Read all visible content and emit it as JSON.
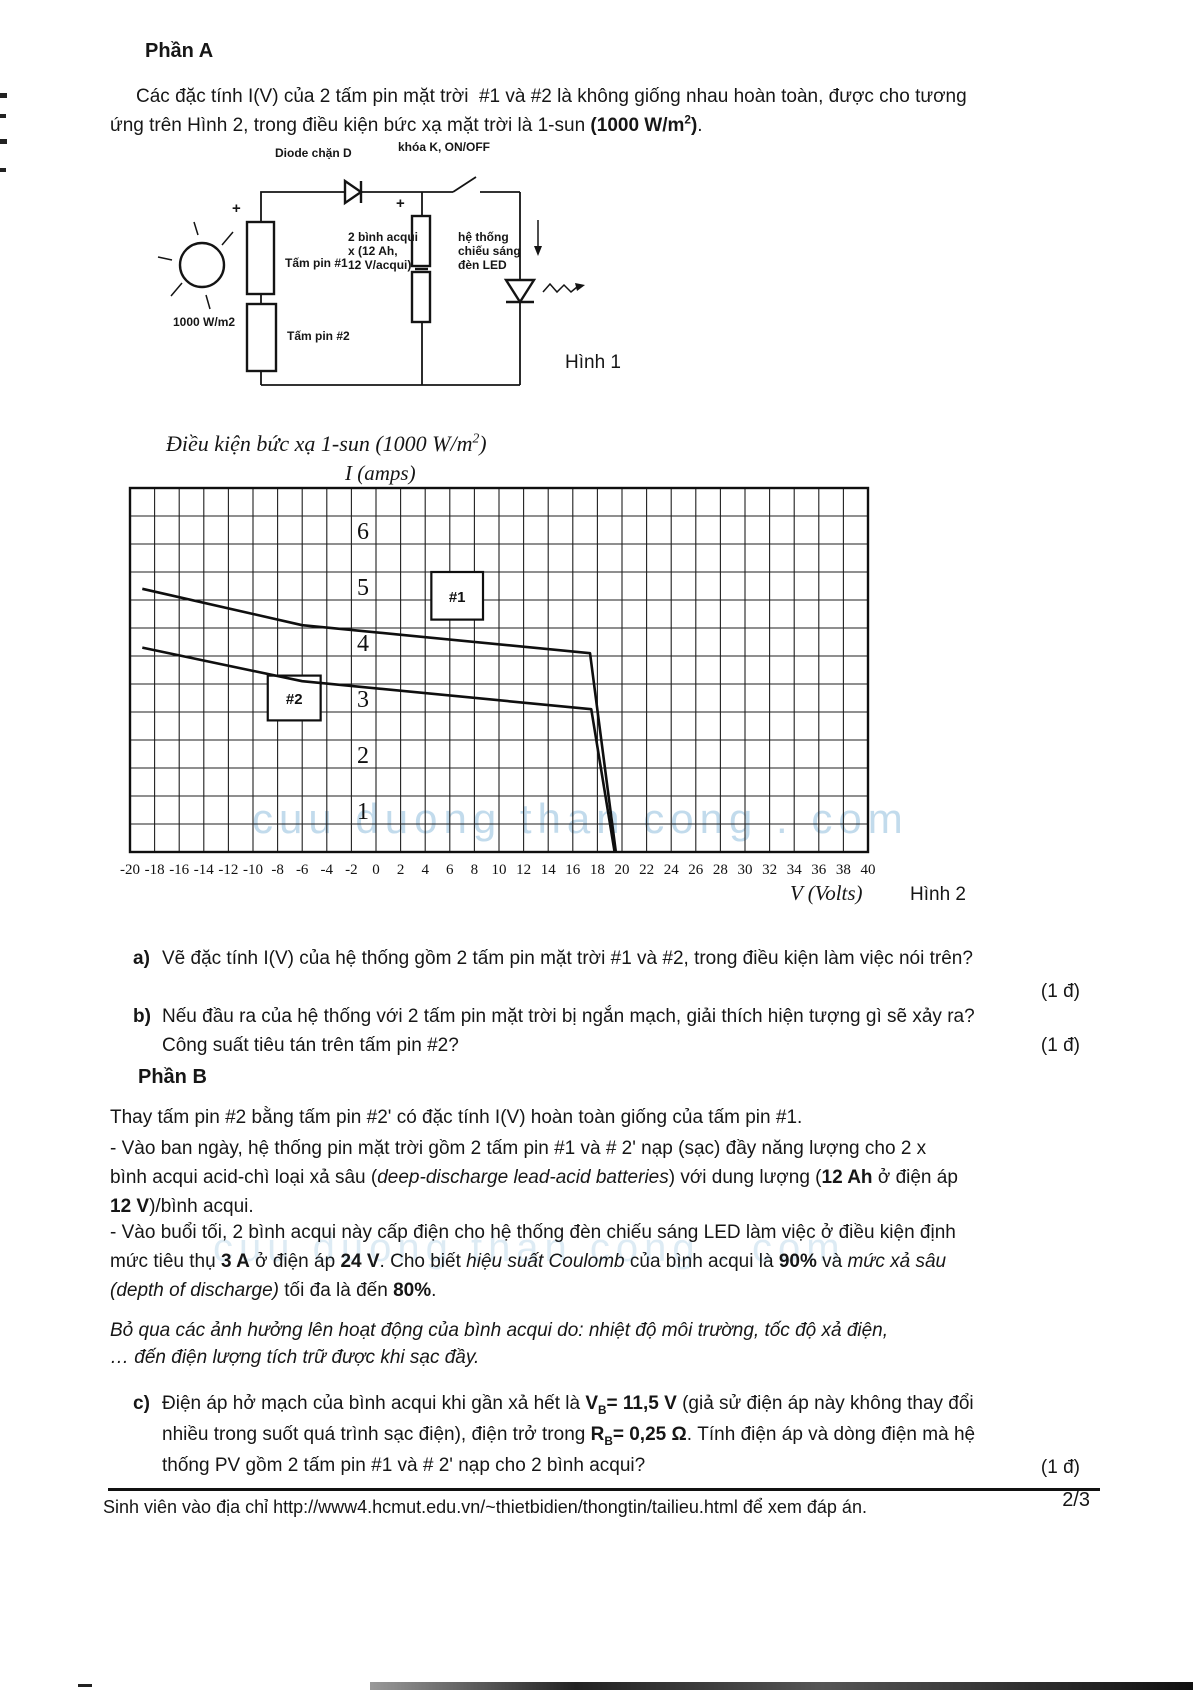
{
  "colors": {
    "ink": "#161616",
    "watermark_blue": "#78afd4",
    "paper": "#ffffff"
  },
  "part_a": {
    "heading": "Phần A",
    "intro_segments": [
      {
        "t": "Các đặc tính I(V) của 2 tấm pin mặt trời  #1 và #2 là không giống nhau hoàn toàn, được cho tương\nứng trên Hình 2, trong điều kiện bức xạ mặt trời là 1-sun "
      },
      {
        "t": "(1000 W/m",
        "b": true
      },
      {
        "t": "2",
        "b": true,
        "sup": true
      },
      {
        "t": ")",
        "b": true
      },
      {
        "t": "."
      }
    ]
  },
  "figure1": {
    "caption": "Hình 1",
    "labels": {
      "diode": "Diode chặn D",
      "switch": "khóa K, ON/OFF",
      "panel1": "Tấm pin #1",
      "panel2": "Tấm pin #2",
      "battery": "2 bình acqui\nx (12 Ah,\n12 V/acqui)",
      "led": "hệ thống\nchiếu sáng\nđèn LED",
      "irradiance": "1000 W/m2",
      "plus_panel": "+",
      "plus_battery": "+"
    }
  },
  "figure2": {
    "condition_segments": [
      {
        "t": "Điều kiện bức xạ 1-sun (1000 W/m"
      },
      {
        "t": "2",
        "sup": true
      },
      {
        "t": ")"
      }
    ],
    "y_axis_title": "I (amps)",
    "x_axis_title": "V (Volts)",
    "caption": "Hình 2",
    "watermark": "cuu duong than cong . com"
  },
  "chart_data": {
    "type": "line",
    "title": "Điều kiện bức xạ 1-sun (1000 W/m2)",
    "xlabel": "V (Volts)",
    "ylabel": "I (amps)",
    "xlim": [
      -20,
      40
    ],
    "ylim": [
      0,
      6.5
    ],
    "x_tick_step": 2,
    "y_tick_step": 0.5,
    "grid": true,
    "x_ticks": [
      -20,
      -18,
      -16,
      -14,
      -12,
      -10,
      -8,
      -6,
      -4,
      -2,
      0,
      2,
      4,
      6,
      8,
      10,
      12,
      14,
      16,
      18,
      20,
      22,
      24,
      26,
      28,
      30,
      32,
      34,
      36,
      38,
      40
    ],
    "y_ticks": [
      1,
      2,
      3,
      4,
      5,
      6
    ],
    "series": [
      {
        "name": "#1",
        "points": [
          [
            -19,
            4.7
          ],
          [
            -6,
            4.05
          ],
          [
            17.4,
            3.55
          ],
          [
            19.5,
            0
          ]
        ]
      },
      {
        "name": "#2",
        "points": [
          [
            -19,
            3.65
          ],
          [
            -6,
            3.05
          ],
          [
            17.5,
            2.55
          ],
          [
            19.4,
            0
          ]
        ]
      }
    ],
    "annotations": [
      {
        "label": "#1",
        "v": [
          4.5,
          8.7
        ],
        "i": [
          4.15,
          5.0
        ]
      },
      {
        "label": "#2",
        "v": [
          -8.8,
          -4.5
        ],
        "i": [
          2.35,
          3.15
        ]
      }
    ]
  },
  "questions": {
    "a": {
      "label": "a)",
      "segments": [
        {
          "t": "Vẽ đặc tính I(V) của hệ thống gồm 2 tấm pin mặt trời #1 và #2, trong điều kiện làm việc nói trên?"
        }
      ],
      "points": "(1 đ)"
    },
    "b": {
      "label": "b)",
      "segments": [
        {
          "t": "Nếu đầu ra của hệ thống với 2 tấm pin mặt trời bị ngắn mạch, giải thích hiện tượng gì sẽ xảy ra?\nCông suất tiêu tán trên tấm pin #2?"
        }
      ],
      "points": "(1 đ)"
    },
    "c": {
      "label": "c)",
      "segments": [
        {
          "t": "Điện áp hở mạch của bình acqui khi gần xả hết là "
        },
        {
          "t": "V",
          "b": true
        },
        {
          "t": "B",
          "b": true,
          "sub": true
        },
        {
          "t": "= 11,5 V",
          "b": true
        },
        {
          "t": " (giả sử điện áp này không thay đổi\nnhiều trong suốt quá trình sạc điện), điện trở trong "
        },
        {
          "t": "R",
          "b": true
        },
        {
          "t": "B",
          "b": true,
          "sub": true
        },
        {
          "t": "= 0,25 Ω",
          "b": true
        },
        {
          "t": ". Tính điện áp và dòng điện mà hệ\nthống PV gồm 2 tấm pin #1 và # 2' nạp cho 2 bình acqui?"
        }
      ],
      "points": "(1 đ)"
    }
  },
  "part_b": {
    "heading": "Phần B",
    "p1": "Thay tấm pin #2 bằng tấm pin #2' có đặc tính I(V) hoàn toàn giống của tấm pin #1.",
    "p2_segments": [
      {
        "t": "- Vào ban ngày, hệ thống pin mặt trời gồm 2 tấm pin #1 và # 2' nạp (sạc) đầy năng lượng cho 2 x\nbình acqui acid-chì loại xả sâu ("
      },
      {
        "t": "deep-discharge lead-acid batteries",
        "i": true
      },
      {
        "t": ") với dung lượng ("
      },
      {
        "t": "12 Ah",
        "b": true
      },
      {
        "t": " ở điện áp\n"
      },
      {
        "t": "12 V",
        "b": true
      },
      {
        "t": ")/bình acqui."
      }
    ],
    "p3_segments": [
      {
        "t": "- Vào buổi tối, 2 bình acqui này cấp điện cho hệ thống đèn chiếu sáng LED làm việc ở điều kiện định\nmức tiêu thụ "
      },
      {
        "t": "3 A",
        "b": true
      },
      {
        "t": " ở điện áp "
      },
      {
        "t": "24 V",
        "b": true
      },
      {
        "t": ". Cho biết "
      },
      {
        "t": "hiệu suất Coulomb",
        "i": true
      },
      {
        "t": " của bình acqui là "
      },
      {
        "t": "90%",
        "b": true
      },
      {
        "t": " và "
      },
      {
        "t": "mức xả sâu",
        "i": true
      },
      {
        "t": "\n"
      },
      {
        "t": "(depth of discharge)",
        "i": true
      },
      {
        "t": " tối đa là đến "
      },
      {
        "t": "80%",
        "b": true
      },
      {
        "t": "."
      }
    ],
    "p4_segments": [
      {
        "t": "Bỏ qua các ảnh hưởng lên hoạt động của bình acqui do: nhiệt độ môi trường, tốc độ xả điện,\n… đến điện lượng tích trữ được khi sạc đầy.",
        "i": true
      }
    ]
  },
  "footer": {
    "note": "Sinh viên vào địa chỉ http://www4.hcmut.edu.vn/~thietbidien/thongtin/tailieu.html để xem đáp án.",
    "page": "2/3"
  }
}
